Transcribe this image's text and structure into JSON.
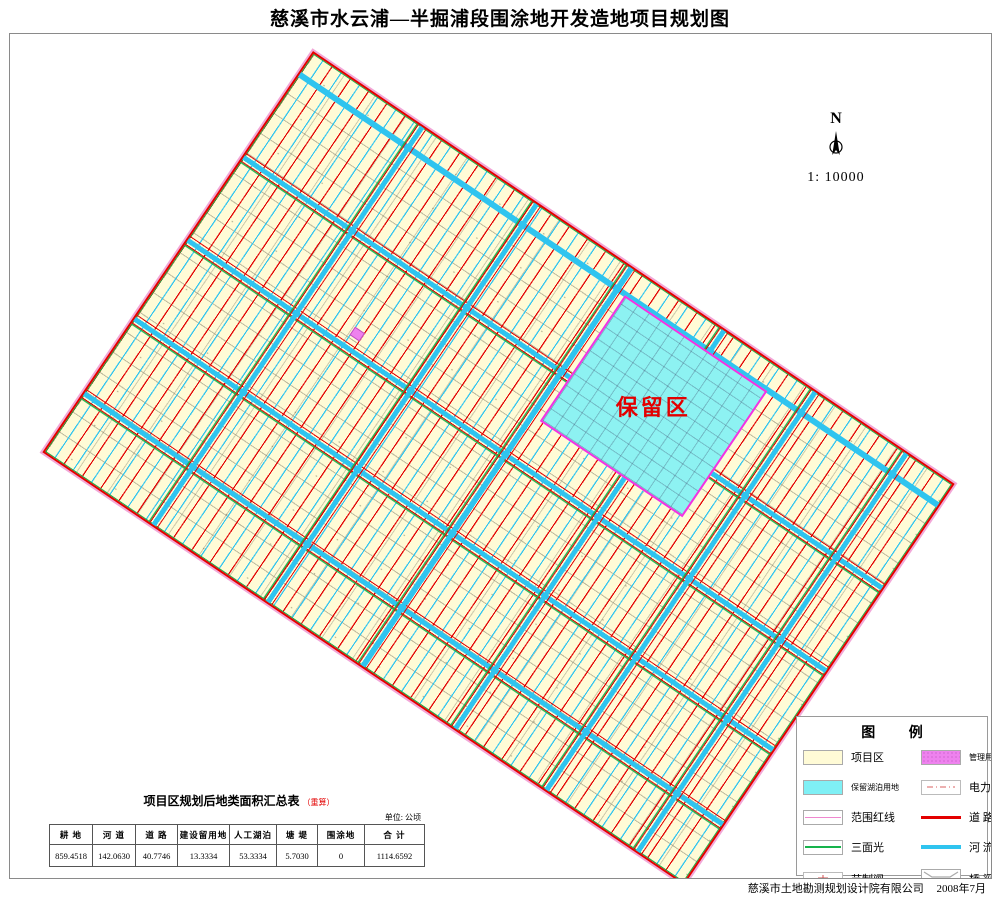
{
  "title": "慈溪市水云浦—半掘浦段围涂地开发造地项目规划图",
  "map": {
    "reserved_area_label": "保留区",
    "compass": {
      "north_label": "N",
      "scale": "1: 10000"
    }
  },
  "legend": {
    "title": "图 例",
    "items": [
      {
        "key": "project-area",
        "label": "项目区"
      },
      {
        "key": "management-house",
        "label": "管理用房"
      },
      {
        "key": "reserved-lake-land",
        "label": "保留湖泊用地"
      },
      {
        "key": "power-line",
        "label": "电力线路"
      },
      {
        "key": "boundary-red-line",
        "label": "范围红线"
      },
      {
        "key": "road",
        "label": "道 路"
      },
      {
        "key": "three-sided-lined-canal",
        "label": "三面光"
      },
      {
        "key": "river",
        "label": "河 流"
      },
      {
        "key": "control-gate",
        "label": "节制闸"
      },
      {
        "key": "bridge",
        "label": "桥 梁"
      }
    ]
  },
  "area_table": {
    "title": "项目区规划后地类面积汇总表",
    "title_note": "（重算）",
    "unit": "单位: 公顷",
    "columns": [
      "耕 地",
      "河 道",
      "道 路",
      "建设留用地",
      "人工湖泊",
      "塘 堤",
      "围涂地",
      "合 计"
    ],
    "values": [
      "859.4518",
      "142.0630",
      "40.7746",
      "13.3334",
      "53.3334",
      "5.7030",
      "0",
      "1114.6592"
    ]
  },
  "footer": {
    "company": "慈溪市土地勘测规划设计院有限公司",
    "date": "2008年7月"
  },
  "colors": {
    "parcel_cream": "#fffbd6",
    "road_red": "#e30000",
    "river_cyan": "#2fc4ef",
    "canal_green": "#17b34c",
    "boundary_magenta": "#f531e2",
    "reserved_fill": "#8df2f2",
    "management_pink": "#ee82ee"
  }
}
